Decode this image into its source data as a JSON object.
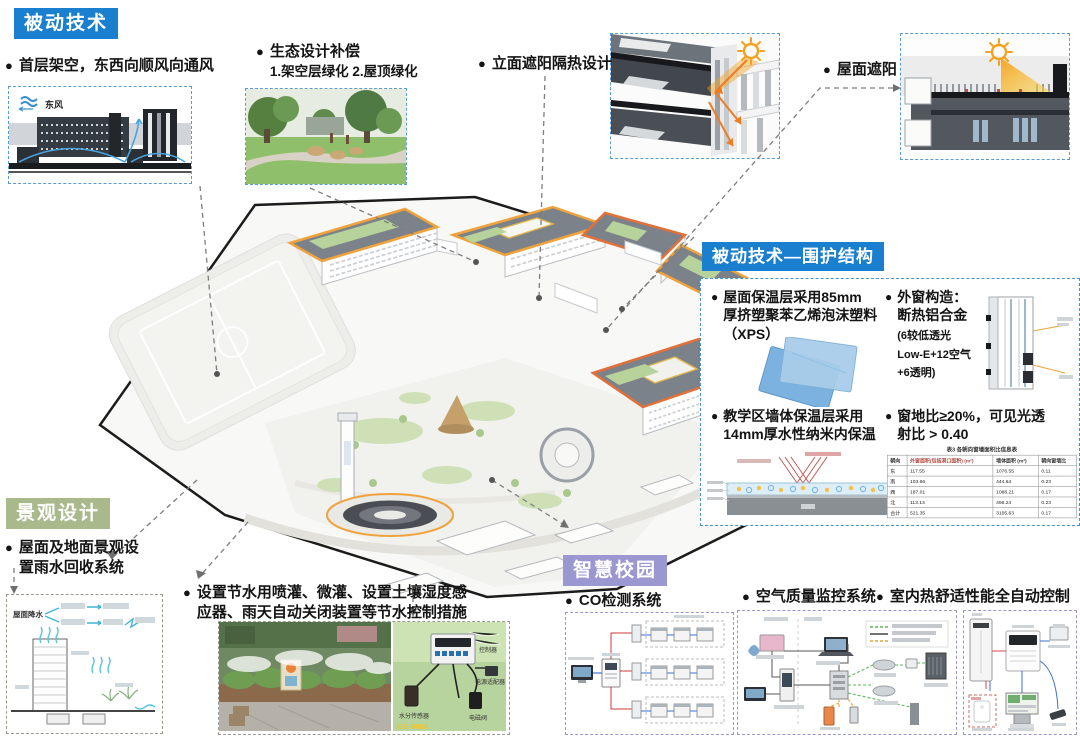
{
  "sections": {
    "passive": {
      "title": "被动技术",
      "color": "#1b7fd0"
    },
    "envelope_title": "被动技术—围护结构",
    "landscape": {
      "title": "景观设计",
      "color": "#a9b98b"
    },
    "smart": {
      "title": "智慧校园",
      "color": "#9b97d0"
    }
  },
  "callouts": {
    "stilt": {
      "label": "首层架空，东西向顺风向通风",
      "wind": "东风"
    },
    "eco": {
      "label": "生态设计补偿",
      "sub": "1.架空层绿化  2.屋顶绿化"
    },
    "facade": {
      "label": "立面遮阳隔热设计"
    },
    "roofshade": {
      "label": "屋面遮阳"
    }
  },
  "envelope": {
    "items": {
      "roof": [
        "屋面保温层采用85mm",
        "厚挤塑聚苯乙烯泡沫塑料",
        "（XPS）"
      ],
      "window_head": [
        "外窗构造：",
        "断热铝合金"
      ],
      "window_sub": [
        "(6较低透光",
        "Low-E+12空气",
        "+6透明)"
      ],
      "wall": [
        "教学区墙体保温层采用",
        "14mm厚水性纳米内保温"
      ],
      "ratio": [
        "窗地比≥20%，可见光透",
        "射比 > 0.40"
      ]
    },
    "table": {
      "title": "表3 各朝向窗墙面积比信息表",
      "headers": [
        "朝向",
        "外窗面积(包括洞口面积) (m²)",
        "墙体面积 (m²)",
        "朝向窗墙比"
      ],
      "rows": [
        [
          "东",
          "117.55",
          "1076.55",
          "0.11"
        ],
        [
          "南",
          "103.66",
          "444.64",
          "0.23"
        ],
        [
          "西",
          "187.01",
          "1088.21",
          "0.17"
        ],
        [
          "北",
          "113.13",
          "496.24",
          "0.23"
        ],
        [
          "合计",
          "521.35",
          "3105.63",
          "0.17"
        ]
      ]
    }
  },
  "landscape": {
    "rain": [
      "屋面及地面景观设",
      "置雨水回收系统"
    ],
    "rain_source": "屋面降水",
    "irrigation": [
      "设置节水用喷灌、微灌、设置土壤湿度感",
      "应器、雨天自动关闭装置等节水控制措施"
    ],
    "sensor": {
      "controller": "控制器",
      "power": "电源适配器",
      "moisture": "水分传感器",
      "valve": "电磁阀",
      "model": "GG-008A"
    }
  },
  "smart": {
    "co": "CO检测系统",
    "air": "空气质量监控系统",
    "thermal": "室内热舒适性能全自动控制"
  }
}
